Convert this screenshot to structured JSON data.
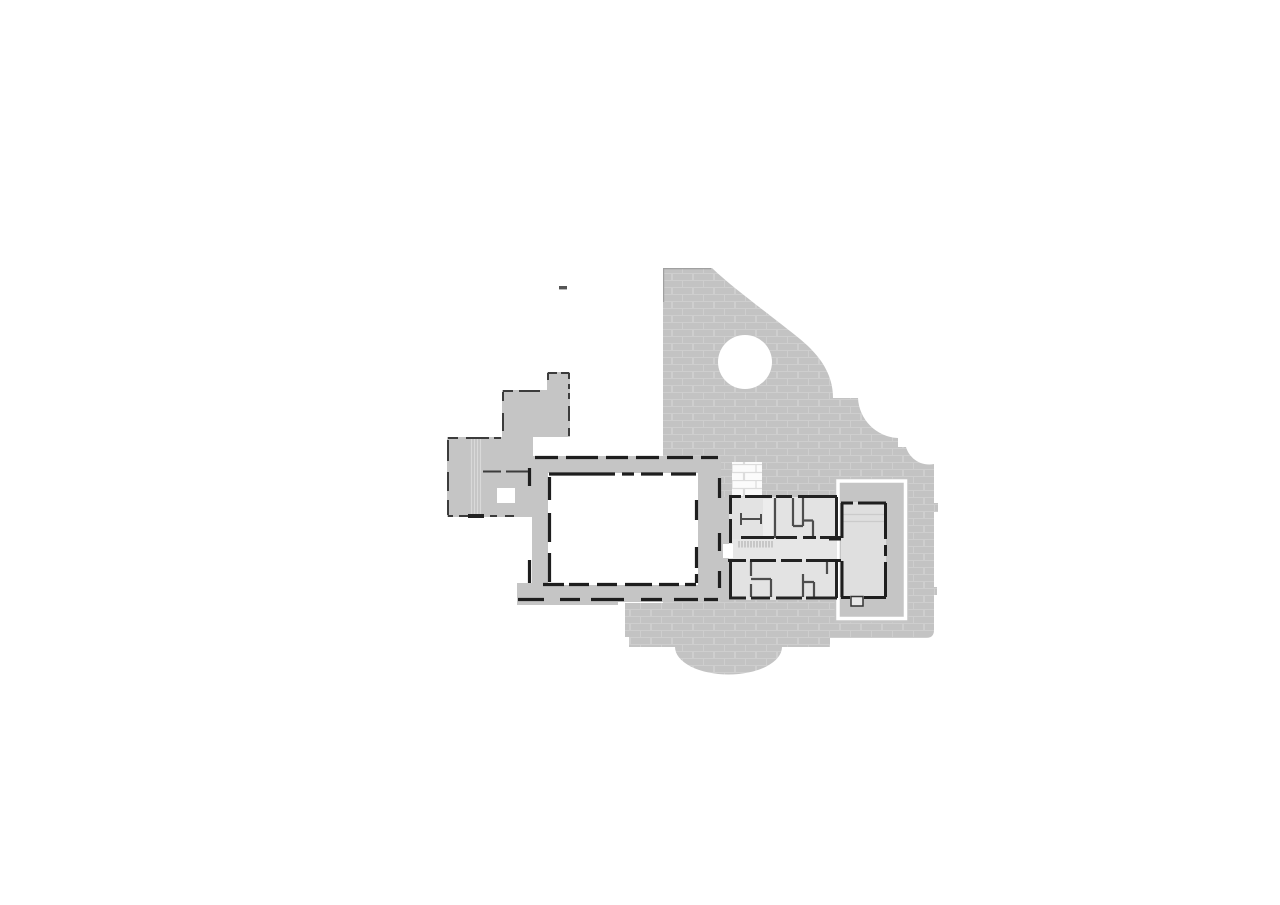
{
  "document": {
    "type": "architectural-floor-plan",
    "description": "monochrome scanned floor plan of a monastic/castle complex: masonry mass with round tower void, cloister courtyard, stepped west wing, cell block with corridor, chapel block outlined in white, semicircular apse",
    "background": "#ffffff"
  },
  "palette": {
    "white": "#ffffff",
    "masonry_base": "#c3c3c3",
    "masonry_mortar": "#cecece",
    "flat_gray": "#c5c5c5",
    "room_fill": "#e3e3e3",
    "corridor_fill": "#e6e6e6",
    "chapel_fill": "#dfdfdf",
    "light_brick": "#fbfbfb",
    "light_brick_mortar": "#dcdcdc",
    "wall_dark": "#1e1e1e",
    "wall_black": "#222222",
    "wall_medium": "#4d4d4d",
    "dash_thin": "#3c3c3c",
    "stair_tick": "#a8a8a8",
    "arm_stair_line": "#d9d9d9",
    "niche_fill": "#ededed",
    "faint_line": "#cbcbcb",
    "notch_fill": "#e8e8e8",
    "notch_stroke": "#333333",
    "edge_tick": "#a0a0a0",
    "mark_gray": "#555555",
    "seam_white": "#ffffff"
  },
  "plan_parts": {
    "masonry_mass": "large hatched masonry footprint with curved north-east boundary and stepped east edge",
    "tower_void": "circular white void (round tower interior)",
    "apse": "semicircular apse bulge on the south edge",
    "courtyard": "rectangular white cloister courtyard with dashed wall traces",
    "west_wing": "stepped flat-gray west wing with stair lines and window void",
    "cell_block": "room block with central corridor, stair treads and partition walls",
    "chapel_block": "east room outlined by a white border frame, with door notch and step lines",
    "survey_mark": "small isolated dark dash north-west of the plan"
  }
}
